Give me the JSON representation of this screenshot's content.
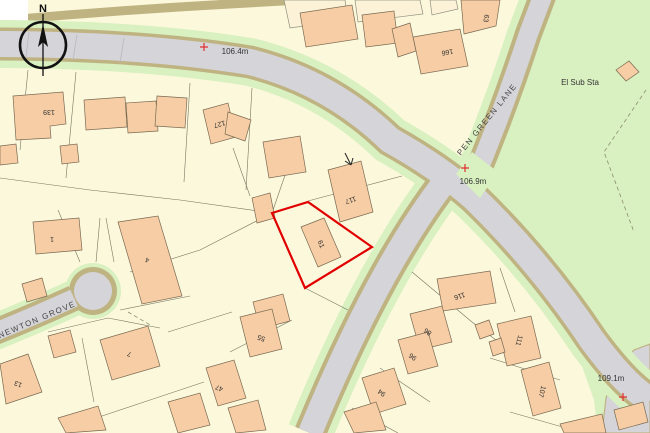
{
  "map": {
    "compass_north": "N",
    "streets": {
      "pen_green_lane": "PEN GREEN LANE",
      "newton_grove": "NEWTON GROVE"
    },
    "feature_labels": {
      "el_sub_sta": "El Sub Sta"
    },
    "spot_heights": [
      "106.4m",
      "106.9m",
      "109.1m"
    ],
    "house_numbers": [
      "139",
      "127",
      "166",
      "63",
      "117",
      "61",
      "55",
      "47",
      "1",
      "4",
      "13",
      "7",
      "116",
      "86",
      "96",
      "94",
      "111",
      "107"
    ],
    "colors": {
      "background": "#fcf8dc",
      "building_fill": "#f6cda4",
      "road_fill": "#d5d4d9",
      "road_casing": "#bfb382",
      "verge_green": "#d9f0c0",
      "open_land_green": "#d9f0c0",
      "plot_outline": "#e10000",
      "spot_height_cross": "#e03030"
    }
  }
}
